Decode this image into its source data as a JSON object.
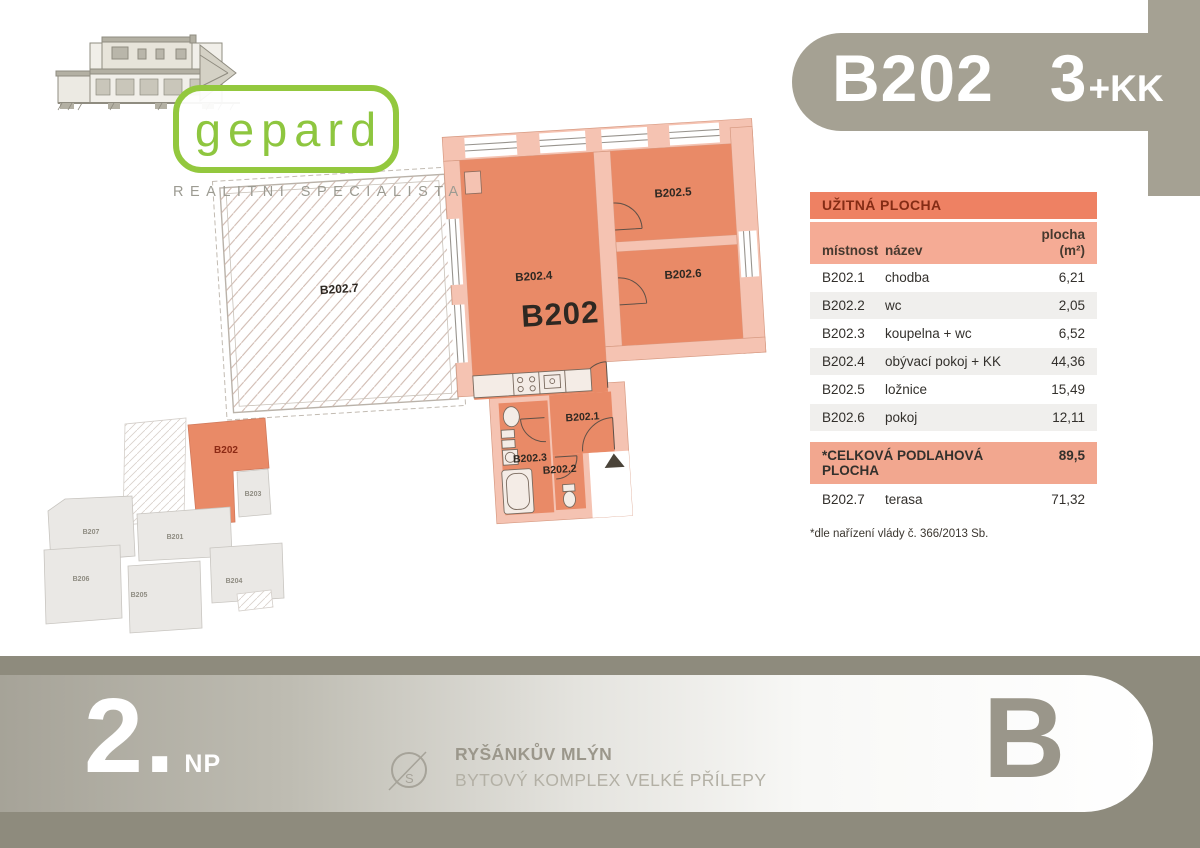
{
  "badge": {
    "unit": "B202",
    "rooms": "3",
    "kk_suffix": "+KK"
  },
  "logo": {
    "brand": "gepard",
    "tagline": "REALITNI SPECIALISTA"
  },
  "floorplan": {
    "main_label": "B202",
    "terrace_label": "B202.7",
    "room_labels": [
      "B202.4",
      "B202.5",
      "B202.6",
      "B202.1",
      "B202.3",
      "B202.2"
    ]
  },
  "table": {
    "title": "UŽITNÁ PLOCHA",
    "columns": {
      "room": "místnost",
      "name": "název",
      "area_line1": "plocha",
      "area_line2": "(m²)"
    },
    "rows": [
      {
        "room": "B202.1",
        "name": "chodba",
        "area": "6,21"
      },
      {
        "room": "B202.2",
        "name": "wc",
        "area": "2,05"
      },
      {
        "room": "B202.3",
        "name": "koupelna + wc",
        "area": "6,52"
      },
      {
        "room": "B202.4",
        "name": "obývací pokoj + KK",
        "area": "44,36"
      },
      {
        "room": "B202.5",
        "name": "ložnice",
        "area": "15,49"
      },
      {
        "room": "B202.6",
        "name": "pokoj",
        "area": "12,11"
      }
    ],
    "total": {
      "label": "*CELKOVÁ PODLAHOVÁ PLOCHA",
      "area": "89,5"
    },
    "terrace_row": {
      "room": "B202.7",
      "name": "terasa",
      "area": "71,32"
    },
    "footnote": "*dle nařízení vlády č. 366/2013 Sb."
  },
  "siteplan": {
    "highlight_label": "B202",
    "unit_labels": [
      "B203",
      "B207",
      "B201",
      "B206",
      "B205",
      "B204"
    ]
  },
  "footer": {
    "floor_number": "2.",
    "floor_suffix": "NP",
    "compass_letter": "S",
    "project_title": "RYŠÁNKŮV MLÝN",
    "project_subtitle": "BYTOVÝ KOMPLEX VELKÉ PŘÍLEPY",
    "block_letter": "B"
  },
  "colors": {
    "room_fill": "#e98a67",
    "wall_fill": "#f5c3b2",
    "badge_gray": "#a5a193",
    "brand_green": "#8ec63f",
    "table_header": "#ee8163"
  }
}
